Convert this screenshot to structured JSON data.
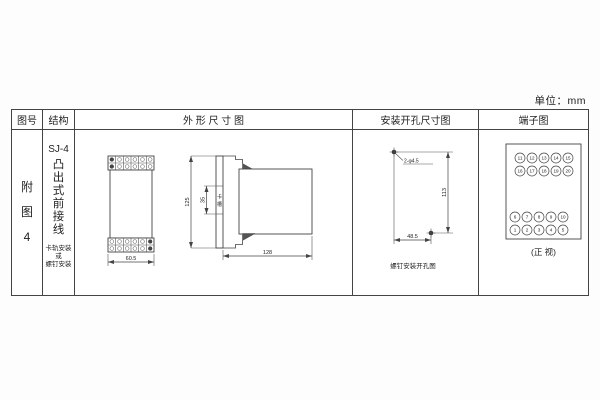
{
  "unit_label": "单位：mm",
  "table": {
    "headers": [
      "图号",
      "结构",
      "外 形 尺 寸 图",
      "安装开孔尺寸图",
      "端子图"
    ]
  },
  "fig_no": {
    "chars": [
      "附",
      "图",
      "4"
    ]
  },
  "structure": {
    "model": "SJ-4",
    "chars": [
      "凸",
      "出",
      "式",
      "前",
      "接",
      "线"
    ],
    "mount_lines": [
      "卡轨安装",
      "或",
      "螺钉安装"
    ]
  },
  "outline": {
    "front_width": "60.5",
    "height": "125",
    "slot_dim": "35",
    "slot_label_chars": [
      "卡",
      "槽"
    ],
    "depth": "128"
  },
  "mounting": {
    "hole_label": "2-φ4.5",
    "vertical_dim": "113",
    "horizontal_dim": "48.5",
    "caption": "螺钉安装开孔图"
  },
  "terminal": {
    "top_rows": [
      [
        "11",
        "12",
        "13",
        "14",
        "15"
      ],
      [
        "16",
        "17",
        "18",
        "19",
        "20"
      ]
    ],
    "bottom_rows": [
      [
        "6",
        "7",
        "8",
        "9",
        "10"
      ],
      [
        "1",
        "2",
        "3",
        "4",
        "5"
      ]
    ],
    "caption": "(正 视)"
  }
}
